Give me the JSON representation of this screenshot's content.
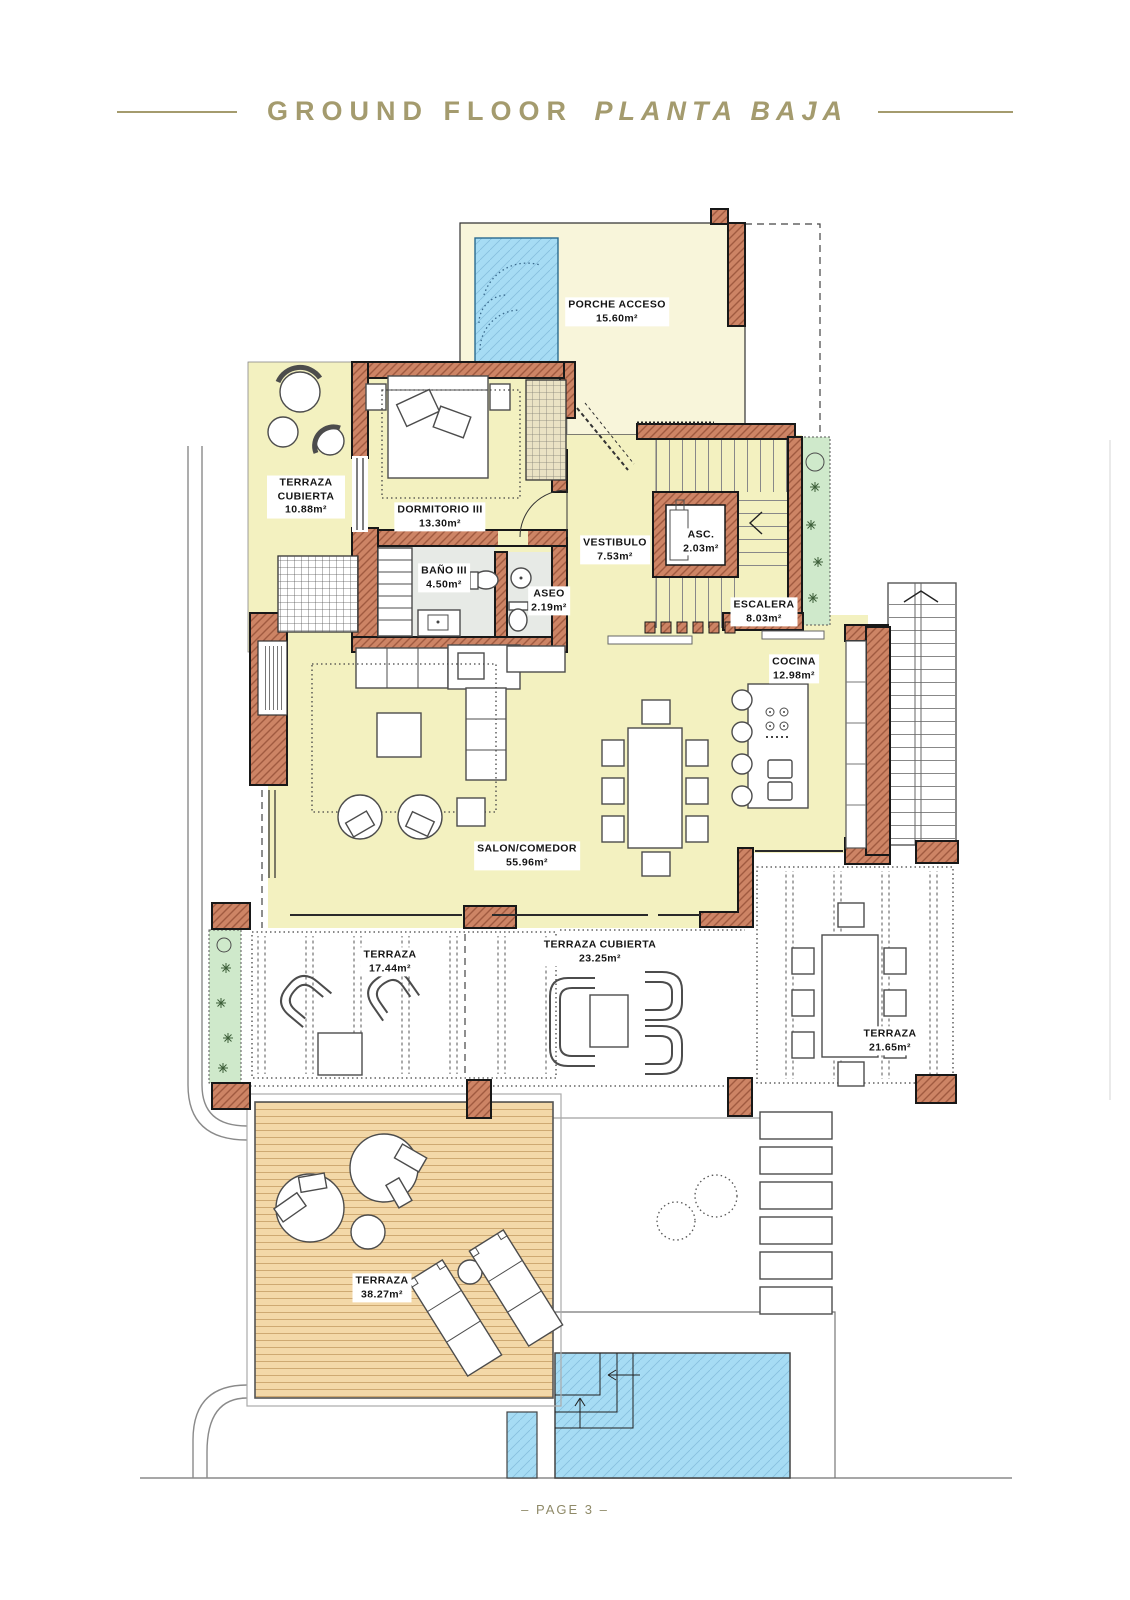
{
  "page": {
    "title_primary": "GROUND FLOOR",
    "title_secondary": "PLANTA BAJA",
    "footer": "– PAGE 3 –"
  },
  "colors": {
    "paper": "#ffffff",
    "title": "#a49b6e",
    "wall": "#cd8465",
    "wall_hatch": "#a05a40",
    "floor": "#f3f1c0",
    "porch": "#f8f5da",
    "bath_floor": "#e7eae6",
    "pool": "#a6dcf4",
    "pool_hatch": "#5f9ec4",
    "deck": "#f3d8a8",
    "deck_stripe": "#c29a60",
    "plant": "#cfe9cb",
    "plant_ink": "#3c5e38",
    "site_line": "#8a8a8a"
  },
  "rooms": [
    {
      "id": "porche-acceso",
      "label": "PORCHE ACCESO",
      "area": "15.60m²"
    },
    {
      "id": "terraza-cubierta-10",
      "label": "TERRAZA CUBIERTA",
      "area": "10.88m²"
    },
    {
      "id": "dormitorio-3",
      "label": "DORMITORIO III",
      "area": "13.30m²"
    },
    {
      "id": "vestibulo",
      "label": "VESTIBULO",
      "area": "7.53m²"
    },
    {
      "id": "ascensor",
      "label": "ASC.",
      "area": "2.03m²"
    },
    {
      "id": "bano-3",
      "label": "BAÑO III",
      "area": "4.50m²"
    },
    {
      "id": "aseo",
      "label": "ASEO",
      "area": "2.19m²"
    },
    {
      "id": "escalera",
      "label": "ESCALERA",
      "area": "8.03m²"
    },
    {
      "id": "cocina",
      "label": "COCINA",
      "area": "12.98m²"
    },
    {
      "id": "salon-comedor",
      "label": "SALON/COMEDOR",
      "area": "55.96m²"
    },
    {
      "id": "terraza-17",
      "label": "TERRAZA",
      "area": "17.44m²"
    },
    {
      "id": "terraza-cubierta-23",
      "label": "TERRAZA CUBIERTA",
      "area": "23.25m²"
    },
    {
      "id": "terraza-21",
      "label": "TERRAZA",
      "area": "21.65m²"
    },
    {
      "id": "terraza-38",
      "label": "TERRAZA",
      "area": "38.27m²"
    }
  ]
}
